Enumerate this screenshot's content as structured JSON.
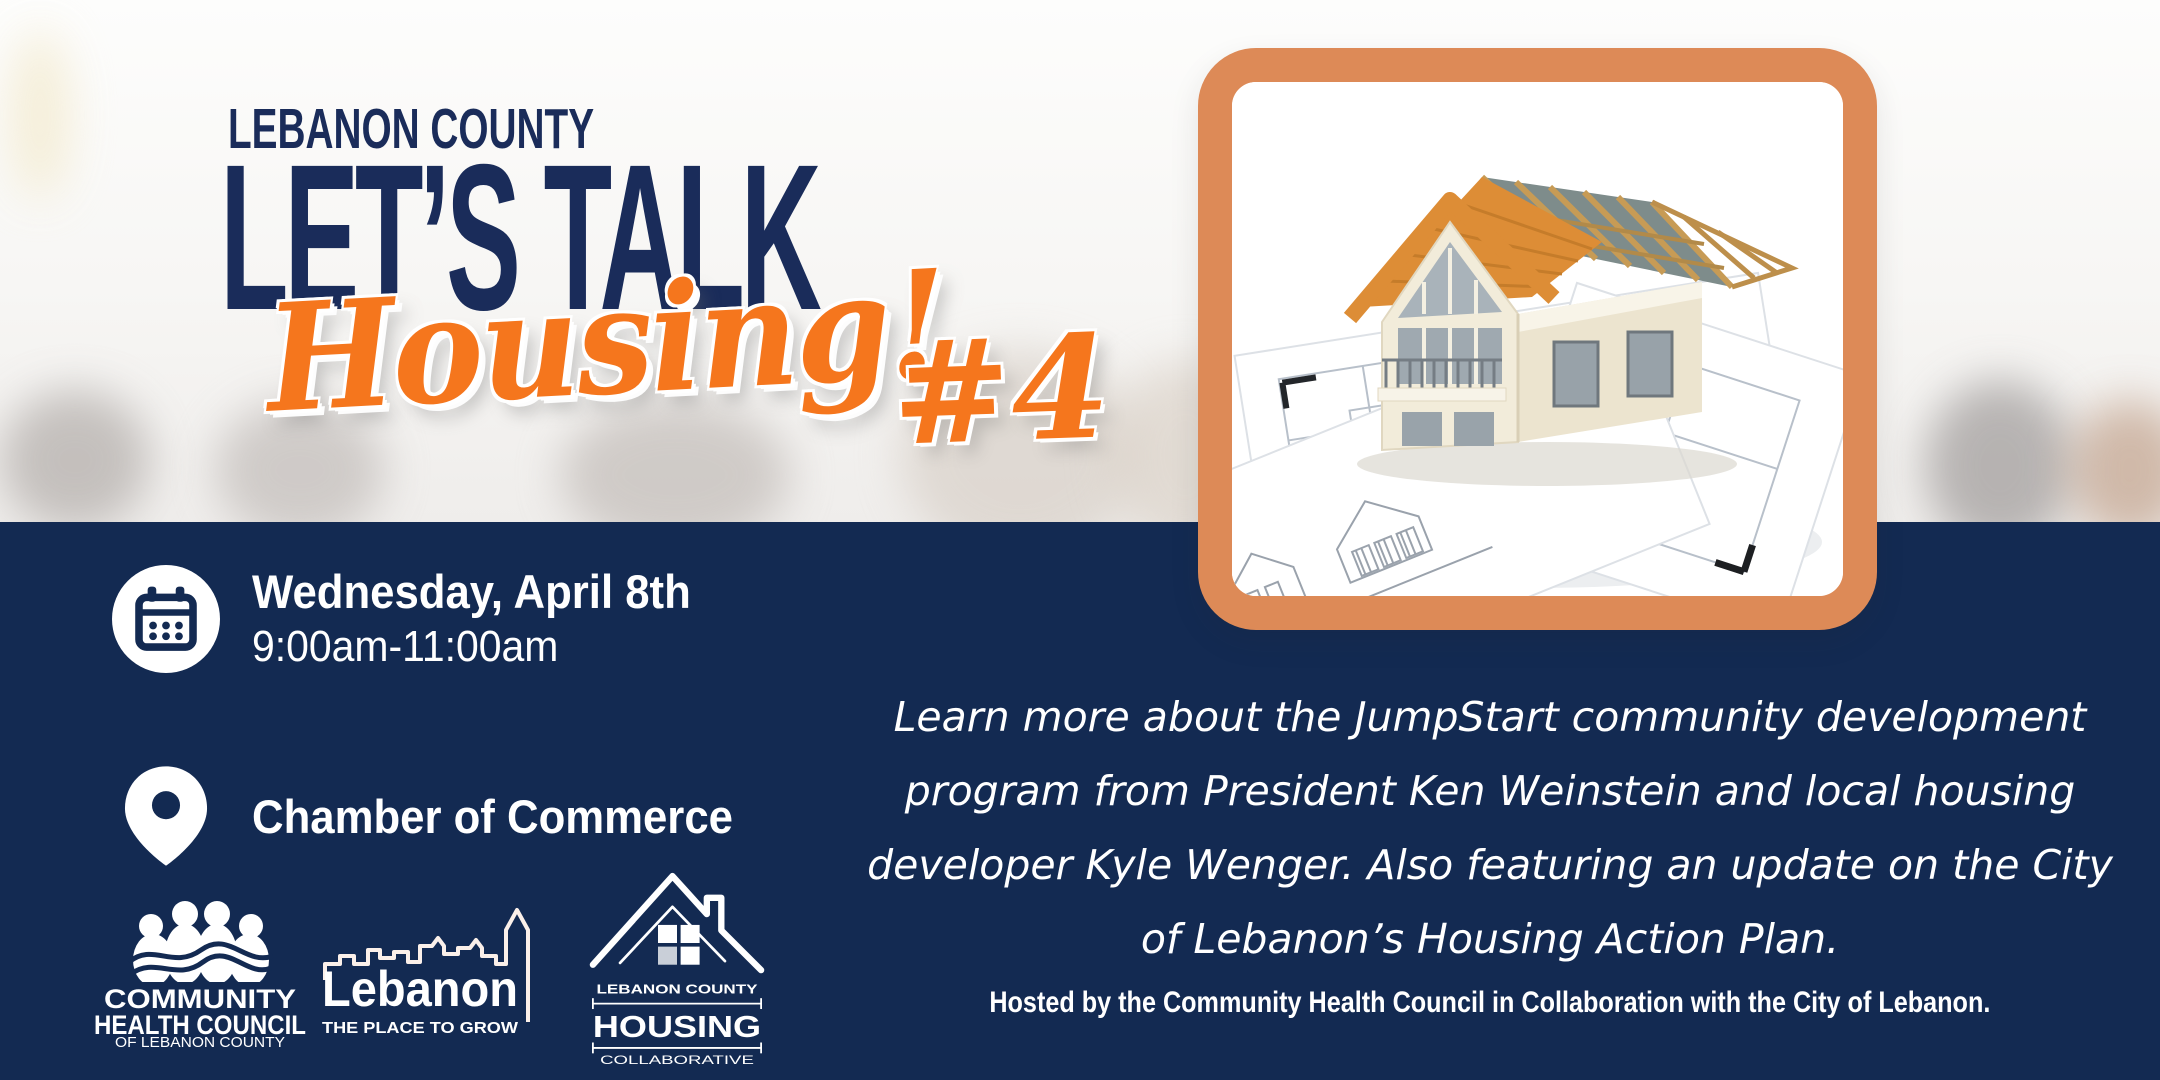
{
  "colors": {
    "navy_band": "#132a52",
    "title_navy": "#1a2c5a",
    "accent_orange": "#f5761d",
    "frame_orange": "#dd8a57",
    "white": "#ffffff"
  },
  "header": {
    "eyebrow": "LEBANON COUNTY",
    "title": "LET’S TALK",
    "script_word": "Housing!",
    "session_number": "#4"
  },
  "event": {
    "date": "Wednesday, April 8th",
    "time": "9:00am-11:00am",
    "location": "Chamber of Commerce"
  },
  "description": "Learn more about the JumpStart community development program from President Ken Weinstein and local housing developer Kyle Wenger. Also featuring an update on the City of Lebanon’s Housing Action Plan.",
  "footer": {
    "hosted_by": "Hosted by the Community Health Council in Collaboration with the City of Lebanon."
  },
  "logos": {
    "community_health_council": {
      "line1": "COMMUNITY",
      "line2": "HEALTH COUNCIL",
      "line3": "OF LEBANON COUNTY"
    },
    "city_of_lebanon": {
      "name": "Lebanon",
      "tagline": "THE PLACE TO GROW"
    },
    "housing_collaborative": {
      "line1": "LEBANON COUNTY",
      "line2": "HOUSING",
      "line3": "COLLABORATIVE"
    }
  },
  "icons": {
    "calendar": "calendar-icon",
    "location": "location-pin-icon",
    "photo": "house-blueprint-photo"
  }
}
